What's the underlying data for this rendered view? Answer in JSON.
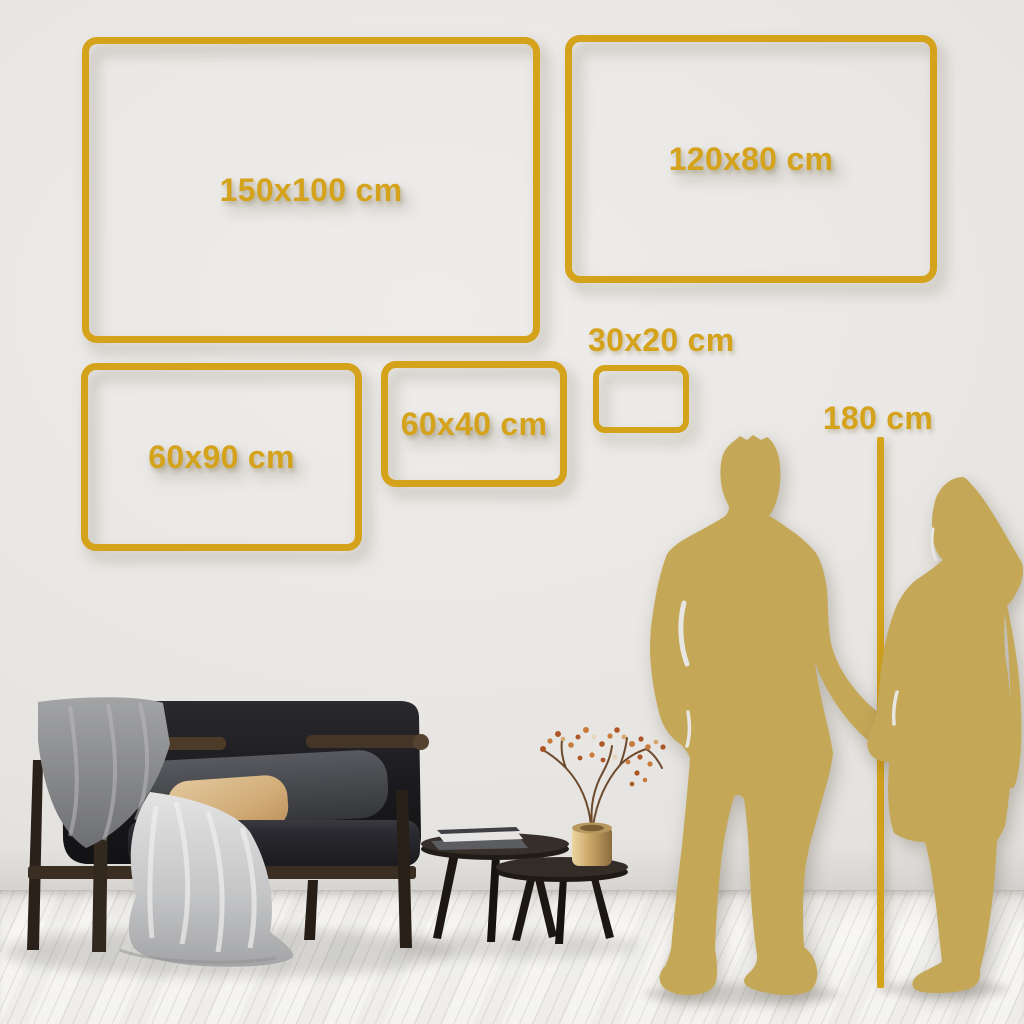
{
  "size_labels": {
    "s150x100": "150x100 cm",
    "s120x80": "120x80 cm",
    "s60x90": "60x90 cm",
    "s60x40": "60x40 cm",
    "s30x20": "30x20 cm"
  },
  "height_reference": {
    "label": "180 cm"
  },
  "colors": {
    "frame_gold": "#d5a21b",
    "silhouette_gold": "#c5a857",
    "wall": "#e8e6e3",
    "floor": "#f4f3f1"
  }
}
